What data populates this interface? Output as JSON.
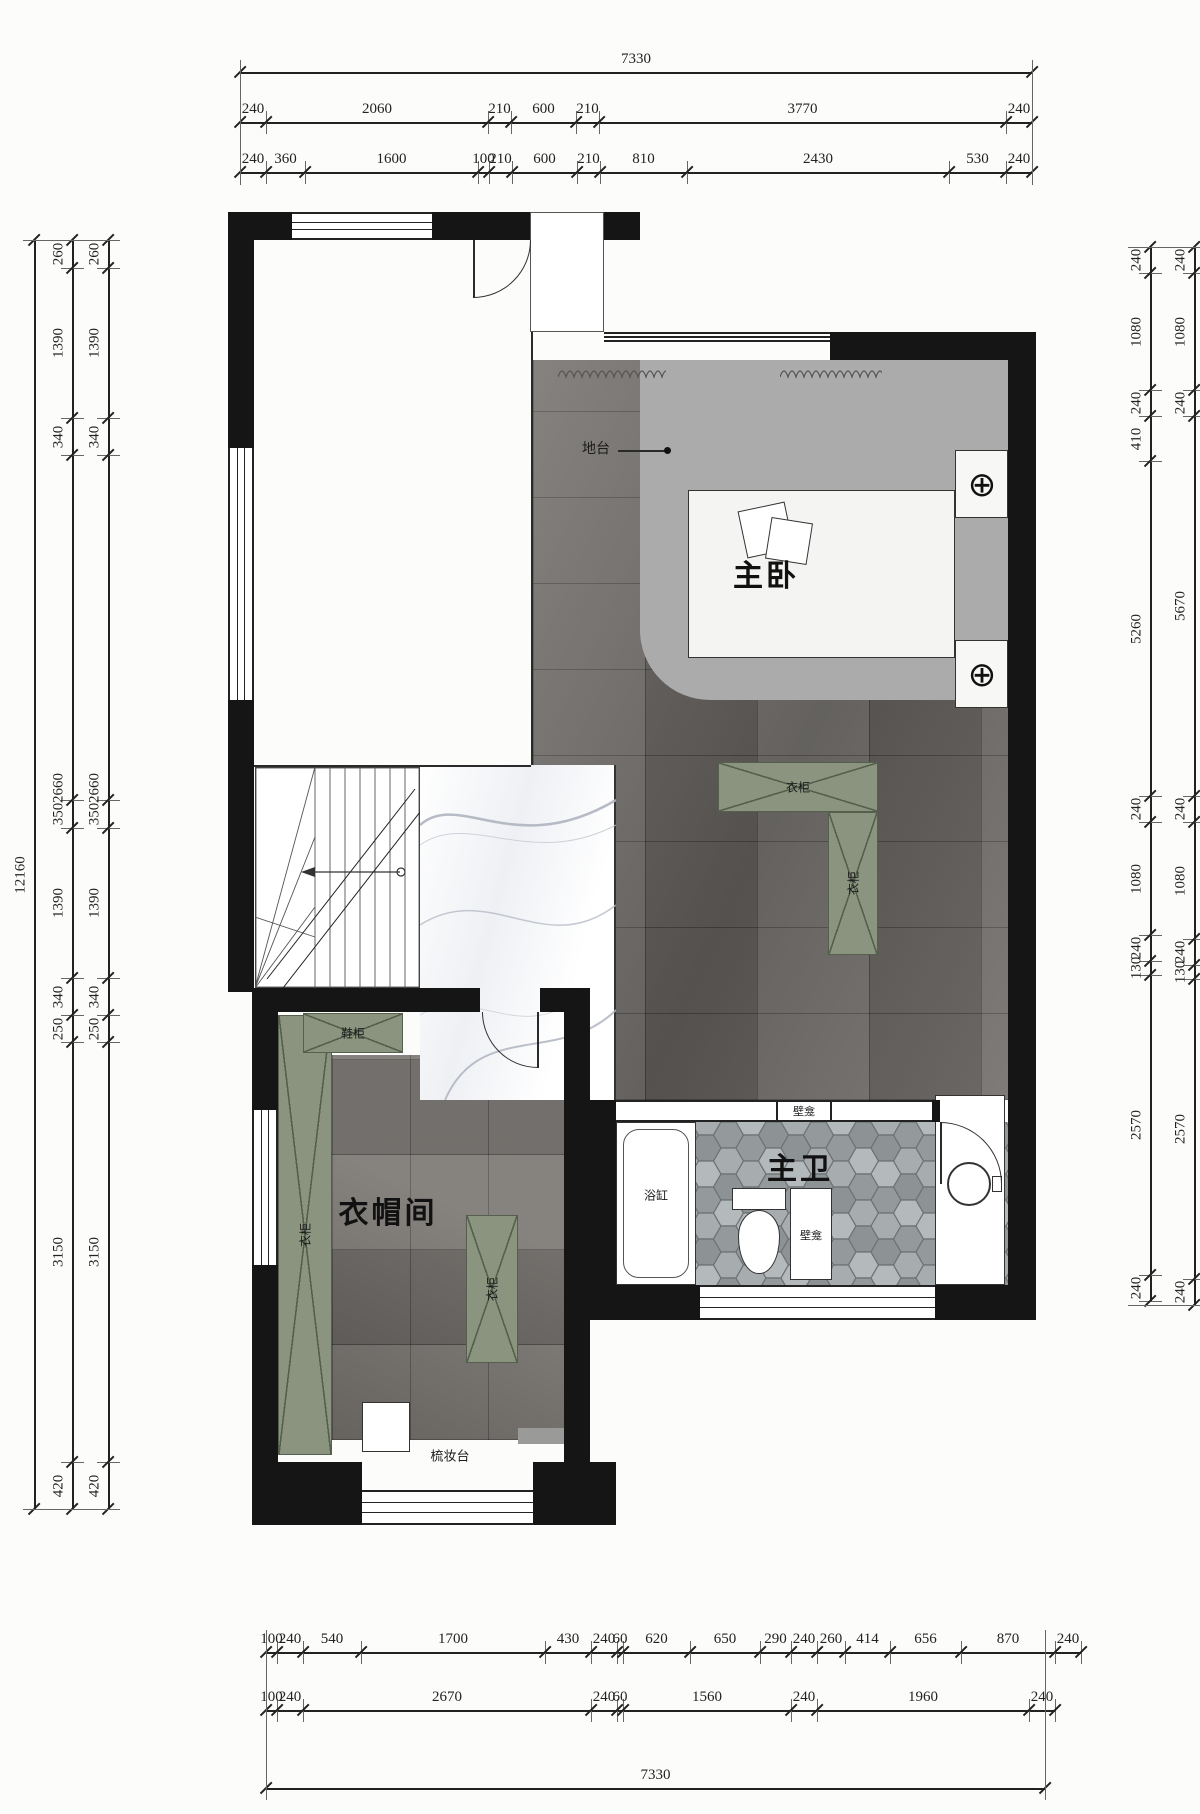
{
  "colors": {
    "wall": "#151515",
    "cabinet_green": "#8a947e",
    "platform_gray": "#ababab"
  },
  "rooms": {
    "master_bedroom": "主卧",
    "master_bath": "主卫",
    "cloakroom": "衣帽间"
  },
  "labels": {
    "platform": "地台",
    "wardrobe": "衣柜",
    "shoe_cabinet": "鞋柜",
    "bathtub": "浴缸",
    "niche": "壁龛",
    "dressing_table": "梳妆台",
    "light_symbol": "⊕"
  },
  "dims": {
    "top": {
      "row1": [
        "7330"
      ],
      "row2": [
        "240",
        "2060",
        "210",
        "600",
        "210",
        "3770",
        "240"
      ],
      "row3": [
        "240",
        "360",
        "1600",
        "100",
        "210",
        "600",
        "210",
        "810",
        "2430",
        "530",
        "240"
      ]
    },
    "bottom": {
      "row1": [
        "100",
        "240",
        "540",
        "1700",
        "430",
        "240",
        "60",
        "620",
        "650",
        "290",
        "240",
        "260",
        "414",
        "656",
        "870",
        "240"
      ],
      "row2": [
        "100",
        "240",
        "2670",
        "240",
        "60",
        "1560",
        "240",
        "1960",
        "240"
      ],
      "row3": [
        "7330"
      ]
    },
    "left": {
      "overall": [
        "12160"
      ],
      "chain": [
        "260",
        "1390",
        "340",
        "2660",
        "350",
        "1390",
        "340",
        "250",
        "3150",
        "420"
      ]
    },
    "right": {
      "inner": [
        "240",
        "1080",
        "240",
        "410",
        "5260",
        "240",
        "1080",
        "240",
        "130",
        "2570",
        "240"
      ],
      "outer": [
        "240",
        "1080",
        "240",
        "5670",
        "240",
        "1080",
        "240",
        "130",
        "2570",
        "240"
      ]
    }
  }
}
